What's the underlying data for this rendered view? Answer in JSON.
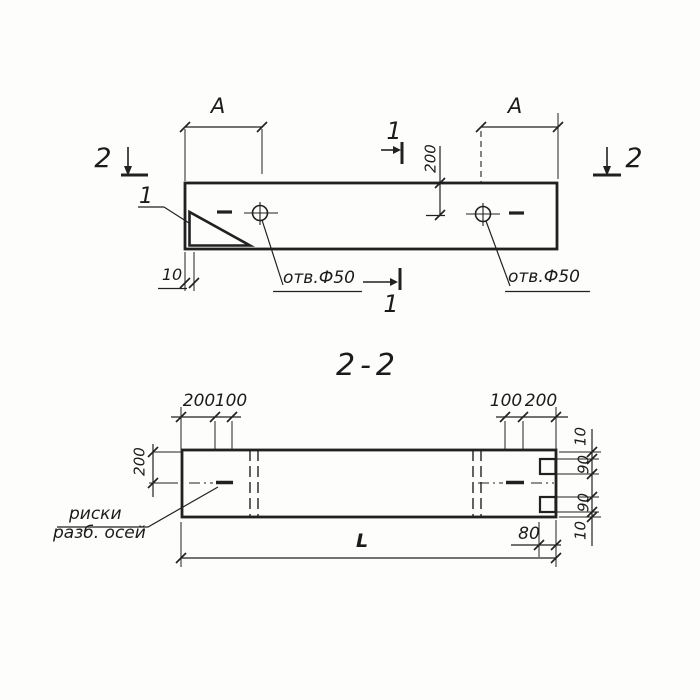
{
  "plan": {
    "marker_2_left": "2",
    "marker_2_right": "2",
    "marker_1_top": "1",
    "marker_1_bottom": "1",
    "detail_ref": "1",
    "dim_a_left": "A",
    "dim_a_right": "A",
    "dim_hole_offset": "200",
    "dim_edge_lip": "10",
    "hole_label_left": "отв.Ф50",
    "hole_label_right": "отв.Ф50"
  },
  "section": {
    "title": "2-2",
    "dim_top_left_200": "200",
    "dim_top_left_100": "100",
    "dim_top_right_100": "100",
    "dim_top_right_200": "200",
    "dim_side_200": "200",
    "dim_right_10_top": "10",
    "dim_right_90_top": "90",
    "dim_right_90_bottom": "90",
    "dim_right_10_bottom": "10",
    "dim_notch_depth": "80",
    "dim_length": "L",
    "axis_note_line1": "риски",
    "axis_note_line2": "разб. осей"
  }
}
